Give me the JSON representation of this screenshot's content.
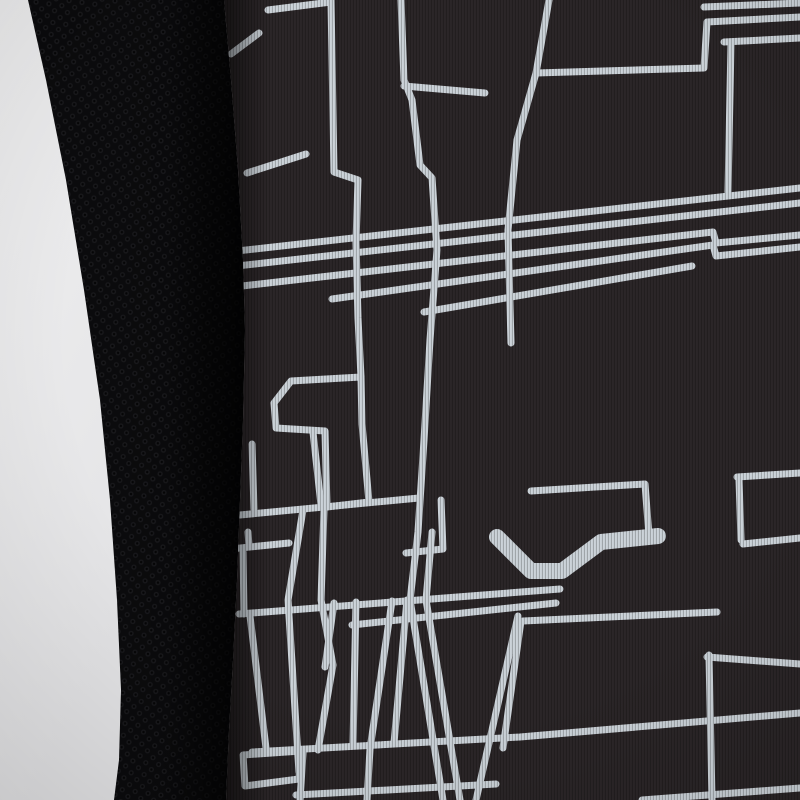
{
  "scene": {
    "description": "Close-up detail photo of a black sports jersey: pale studio background at left, plain black honeycomb mesh side panel, and main shiny fabric printed with a light-grey abstract geometric line pattern on dark charcoal.",
    "colors": {
      "background_top": "#efeff0",
      "background_bottom": "#e4e4e6",
      "mesh_base": "#0b0b0d",
      "mesh_dot": "#19191c",
      "mesh_shadow": "#000000",
      "print_base": "#2b2628",
      "print_rib": "#201c1e",
      "pattern_line": "#ccd3d9",
      "pattern_line_bright": "#dde3e7",
      "seam_shadow": "#131013"
    },
    "background_edge": [
      [
        28,
        0
      ],
      [
        46,
        80
      ],
      [
        66,
        180
      ],
      [
        84,
        290
      ],
      [
        100,
        400
      ],
      [
        110,
        500
      ],
      [
        117,
        600
      ],
      [
        121,
        690
      ],
      [
        119,
        760
      ],
      [
        114,
        800
      ]
    ],
    "print_edge": [
      [
        224,
        0
      ],
      [
        231,
        80
      ],
      [
        238,
        170
      ],
      [
        243,
        260
      ],
      [
        245,
        330
      ],
      [
        243,
        420
      ],
      [
        240,
        500
      ],
      [
        237,
        580
      ],
      [
        233,
        660
      ],
      [
        229,
        730
      ],
      [
        226,
        800
      ]
    ],
    "line_width_default": 7,
    "print_lines": [
      {
        "points": [
          [
            268,
            10
          ],
          [
            331,
            2
          ]
        ]
      },
      {
        "points": [
          [
            331,
            0
          ],
          [
            334,
            172
          ],
          [
            358,
            180
          ],
          [
            356,
            242
          ],
          [
            358,
            318
          ],
          [
            361,
            377
          ]
        ]
      },
      {
        "points": [
          [
            361,
            377
          ],
          [
            291,
            381
          ],
          [
            274,
            403
          ],
          [
            276,
            428
          ],
          [
            325,
            431
          ],
          [
            327,
            507
          ],
          [
            369,
            502
          ],
          [
            362,
            424
          ],
          [
            361,
            377
          ]
        ]
      },
      {
        "points": [
          [
            313,
            432
          ],
          [
            321,
            505
          ]
        ]
      },
      {
        "points": [
          [
            303,
            510
          ],
          [
            288,
            600
          ],
          [
            299,
            772
          ]
        ]
      },
      {
        "points": [
          [
            324,
            509
          ],
          [
            321,
            600
          ],
          [
            333,
            665
          ],
          [
            318,
            750
          ]
        ]
      },
      {
        "points": [
          [
            334,
            603
          ],
          [
            325,
            667
          ]
        ]
      },
      {
        "points": [
          [
            401,
            0
          ],
          [
            404,
            80
          ],
          [
            412,
            100
          ],
          [
            420,
            165
          ],
          [
            432,
            178
          ],
          [
            437,
            250
          ],
          [
            430,
            340
          ],
          [
            424,
            440
          ],
          [
            418,
            532
          ],
          [
            410,
            600
          ],
          [
            443,
            800
          ]
        ]
      },
      {
        "points": [
          [
            404,
            86
          ],
          [
            485,
            93
          ]
        ]
      },
      {
        "points": [
          [
            432,
            532
          ],
          [
            426,
            600
          ],
          [
            460,
            800
          ]
        ]
      },
      {
        "points": [
          [
            228,
            252
          ],
          [
            800,
            188
          ]
        ]
      },
      {
        "points": [
          [
            228,
            267
          ],
          [
            800,
            203
          ]
        ]
      },
      {
        "points": [
          [
            242,
            286
          ],
          [
            713,
            232
          ],
          [
            716,
            243
          ],
          [
            800,
            235
          ]
        ]
      },
      {
        "points": [
          [
            332,
            299
          ],
          [
            713,
            245
          ],
          [
            716,
            256
          ],
          [
            800,
            247
          ]
        ]
      },
      {
        "points": [
          [
            424,
            312
          ],
          [
            692,
            266
          ]
        ]
      },
      {
        "points": [
          [
            549,
            0
          ],
          [
            536,
            73
          ],
          [
            517,
            140
          ],
          [
            508,
            230
          ],
          [
            511,
            343
          ]
        ]
      },
      {
        "points": [
          [
            536,
            73
          ],
          [
            704,
            68
          ],
          [
            707,
            22
          ],
          [
            800,
            17
          ]
        ]
      },
      {
        "points": [
          [
            704,
            7
          ],
          [
            800,
            3
          ]
        ]
      },
      {
        "points": [
          [
            724,
            42
          ],
          [
            800,
            38
          ]
        ]
      },
      {
        "points": [
          [
            731,
            44
          ],
          [
            728,
            192
          ]
        ]
      },
      {
        "points": [
          [
            247,
            173
          ],
          [
            306,
            154
          ]
        ]
      },
      {
        "points": [
          [
            231,
            54
          ],
          [
            259,
            33
          ]
        ]
      },
      {
        "points": [
          [
            252,
            444
          ],
          [
            254,
            509
          ]
        ]
      },
      {
        "points": [
          [
            240,
            515
          ],
          [
            419,
            498
          ]
        ]
      },
      {
        "points": [
          [
            230,
            549
          ],
          [
            289,
            543
          ]
        ]
      },
      {
        "points": [
          [
            243,
            552
          ],
          [
            244,
            614
          ]
        ]
      },
      {
        "points": [
          [
            248,
            532
          ],
          [
            249,
            546
          ]
        ]
      },
      {
        "points": [
          [
            239,
            614
          ],
          [
            560,
            589
          ]
        ]
      },
      {
        "points": [
          [
            352,
            625
          ],
          [
            556,
            603
          ]
        ]
      },
      {
        "points": [
          [
            250,
            616
          ],
          [
            266,
            748
          ]
        ]
      },
      {
        "points": [
          [
            356,
            602
          ],
          [
            353,
            745
          ]
        ]
      },
      {
        "points": [
          [
            392,
            601
          ],
          [
            371,
            742
          ]
        ]
      },
      {
        "points": [
          [
            407,
            600
          ],
          [
            394,
            743
          ]
        ]
      },
      {
        "points": [
          [
            252,
            752
          ],
          [
            520,
            737
          ],
          [
            800,
            713
          ]
        ]
      },
      {
        "points": [
          [
            243,
            755
          ],
          [
            301,
            751
          ],
          [
            299,
            779
          ],
          [
            245,
            786
          ],
          [
            243,
            755
          ]
        ]
      },
      {
        "points": [
          [
            303,
            753
          ],
          [
            300,
            800
          ]
        ]
      },
      {
        "points": [
          [
            370,
            749
          ],
          [
            367,
            800
          ]
        ]
      },
      {
        "points": [
          [
            296,
            795
          ],
          [
            496,
            784
          ]
        ]
      },
      {
        "points": [
          [
            642,
            800
          ],
          [
            800,
            788
          ]
        ]
      },
      {
        "points": [
          [
            709,
            655
          ],
          [
            712,
            800
          ]
        ]
      },
      {
        "points": [
          [
            707,
            657
          ],
          [
            800,
            664
          ]
        ]
      },
      {
        "points": [
          [
            523,
            621
          ],
          [
            717,
            612
          ]
        ]
      },
      {
        "points": [
          [
            531,
            491
          ],
          [
            645,
            484
          ],
          [
            649,
            536
          ]
        ]
      },
      {
        "points": [
          [
            737,
            477
          ],
          [
            800,
            473
          ]
        ]
      },
      {
        "points": [
          [
            739,
            479
          ],
          [
            741,
            540
          ]
        ]
      },
      {
        "points": [
          [
            743,
            544
          ],
          [
            800,
            538
          ]
        ]
      },
      {
        "points": [
          [
            518,
            616
          ],
          [
            476,
            800
          ]
        ]
      },
      {
        "points": [
          [
            521,
            621
          ],
          [
            503,
            748
          ]
        ]
      },
      {
        "points": [
          [
            497,
            537
          ],
          [
            531,
            571
          ],
          [
            562,
            571
          ],
          [
            601,
            542
          ],
          [
            658,
            536
          ]
        ],
        "w": 16
      },
      {
        "points": [
          [
            441,
            500
          ],
          [
            443,
            549
          ],
          [
            406,
            553
          ]
        ]
      }
    ]
  }
}
